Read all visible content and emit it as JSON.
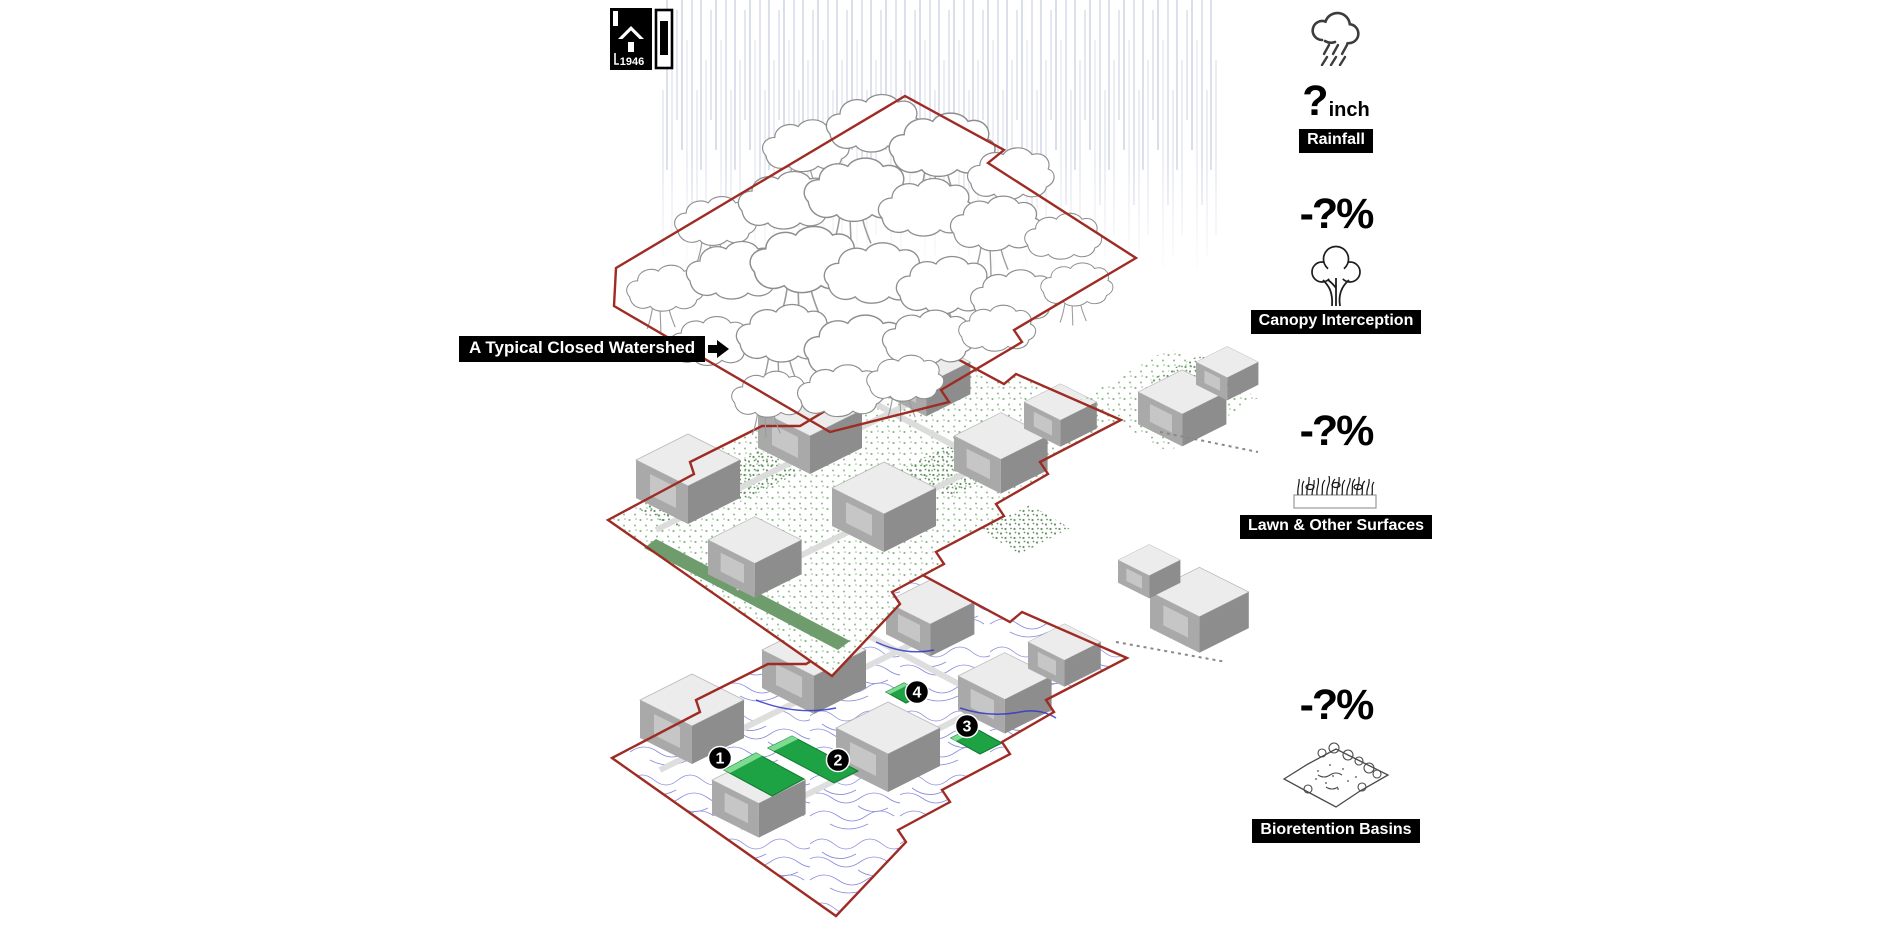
{
  "page": {
    "width": 1900,
    "height": 927,
    "background": "#ffffff"
  },
  "logo": {
    "year": "1946"
  },
  "annotation": {
    "watershed_label": "A Typical Closed Watershed"
  },
  "legend": {
    "rainfall": {
      "value": "?",
      "unit": "inch",
      "label": "Rainfall",
      "icon": "rain-cloud-icon"
    },
    "canopy": {
      "value": "-?%",
      "label": "Canopy Interception",
      "icon": "tree-icon"
    },
    "lawn": {
      "value": "-?%",
      "label": "Lawn & Other Surfaces",
      "icon": "grass-planter-icon"
    },
    "bioretention": {
      "value": "-?%",
      "label": "Bioretention Basins",
      "icon": "bioretention-basin-icon"
    }
  },
  "diagram": {
    "basin_markers": [
      "1",
      "2",
      "3",
      "4"
    ],
    "colors": {
      "watershed_boundary": "#9e2b24",
      "basin_green": "#1ea344",
      "basin_green_light": "#7ddc92",
      "runoff_flow_blue": "#5356cd",
      "lawn_stipple_green": "#8cbb87",
      "hedge_green": "#6f9c6d",
      "rain_streak": "#9aa5c8",
      "building_gray": "#a9a9a9"
    }
  }
}
